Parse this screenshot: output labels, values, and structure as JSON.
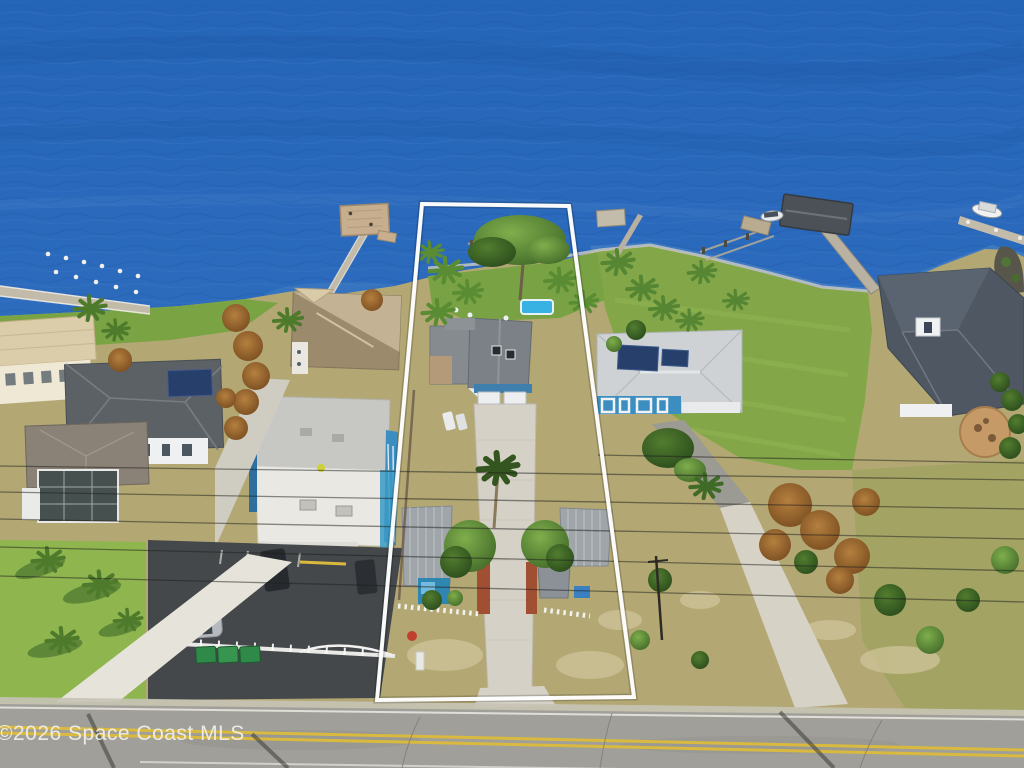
{
  "watermark": {
    "text": "©2026 Space Coast MLS"
  },
  "scene": {
    "type": "aerial-real-estate-photo",
    "subject": "waterfront lot outlined in white beside river, piers, neighboring homes, road in foreground",
    "property_outline": {
      "stroke_width": 4,
      "vertices": "422,204 569,206 634,697 377,700"
    },
    "power_lines": [
      [
        0,
        466,
        1024,
        480
      ],
      [
        0,
        492,
        1024,
        509
      ],
      [
        0,
        519,
        1024,
        539
      ],
      [
        0,
        547,
        1024,
        571
      ],
      [
        0,
        576,
        1024,
        602
      ],
      [
        598,
        455,
        1024,
        463
      ]
    ],
    "colors": {
      "water_deep": "#1f5aa8",
      "water_mid": "#2b6abc",
      "water_light": "#3d7bca",
      "water_shallow": "#4e86c6",
      "grass_green": "#83a748",
      "grass_bright": "#8fb54f",
      "grass_tan": "#b3a874",
      "sand": "#d2c69c",
      "road_asphalt": "#a09f99",
      "road_yellow": "#d9ba3f",
      "asphalt_dark": "#45484b",
      "concrete": "#d5d1c6",
      "roof_gray": "#7b8186",
      "roof_dark": "#4e5762",
      "roof_metal": "#ced2d5",
      "roof_tan": "#b5a287",
      "wall_white": "#edeff0",
      "wall_blue": "#3d8ec0",
      "autumn": "#9a5f2b",
      "tree_green": "#4a7a2d",
      "palm_green": "#5a8c33",
      "pier_wood": "#c3bba9",
      "pool_blue": "#38b2e2",
      "solar_panel": "#27406b",
      "boathouse_roof": "#4b5157",
      "outline_white": "#ffffff",
      "watermark_white": "#f4f4f4"
    }
  }
}
